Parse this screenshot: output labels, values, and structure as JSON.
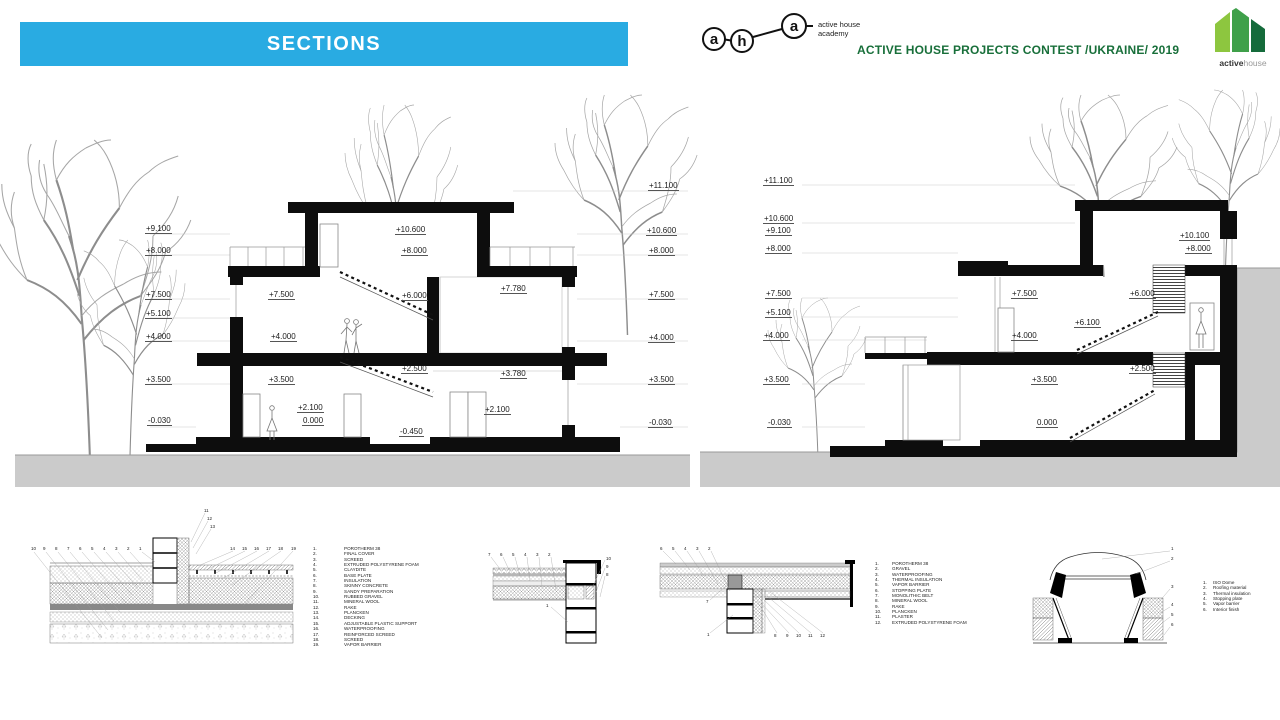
{
  "header": {
    "title": "SECTIONS",
    "academy": {
      "l1": "a",
      "l2": "h",
      "l3": "a",
      "line1": "active house",
      "line2": "academy"
    },
    "contest": "ACTIVE HOUSE  PROJECTS CONTEST /UKRAINE/  2019",
    "brand": {
      "bold": "active",
      "light": "house"
    }
  },
  "colors": {
    "banner_blue": "#29ABE2",
    "contest_green": "#186F3A",
    "logo_light_green": "#8DC63F",
    "logo_mid_green": "#3FA04A",
    "logo_dark_green": "#156B3B",
    "ground_gray": "#CBCBCB"
  },
  "sections": {
    "left": {
      "labels": [
        {
          "t": "+9.100",
          "x": 145,
          "y": 225
        },
        {
          "t": "+8.000",
          "x": 145,
          "y": 247
        },
        {
          "t": "+7.500",
          "x": 145,
          "y": 291
        },
        {
          "t": "+5.100",
          "x": 145,
          "y": 310
        },
        {
          "t": "+4.000",
          "x": 145,
          "y": 333
        },
        {
          "t": "+3.500",
          "x": 145,
          "y": 376
        },
        {
          "t": "-0.030",
          "x": 147,
          "y": 417
        },
        {
          "t": "+7.500",
          "x": 268,
          "y": 291
        },
        {
          "t": "+4.000",
          "x": 270,
          "y": 333
        },
        {
          "t": "+3.500",
          "x": 268,
          "y": 376
        },
        {
          "t": "+2.100",
          "x": 297,
          "y": 404
        },
        {
          "t": "0.000",
          "x": 302,
          "y": 417
        },
        {
          "t": "+10.600",
          "x": 395,
          "y": 226
        },
        {
          "t": "+8.000",
          "x": 401,
          "y": 247
        },
        {
          "t": "+6.000",
          "x": 401,
          "y": 292
        },
        {
          "t": "+2.500",
          "x": 401,
          "y": 365
        },
        {
          "t": "-0.450",
          "x": 399,
          "y": 428
        },
        {
          "t": "+7.780",
          "x": 500,
          "y": 285
        },
        {
          "t": "+3.780",
          "x": 500,
          "y": 370
        },
        {
          "t": "+2.100",
          "x": 484,
          "y": 406
        },
        {
          "t": "+11.100",
          "x": 648,
          "y": 182
        },
        {
          "t": "+10.600",
          "x": 646,
          "y": 227
        },
        {
          "t": "+8.000",
          "x": 648,
          "y": 247
        },
        {
          "t": "+7.500",
          "x": 648,
          "y": 291
        },
        {
          "t": "+4.000",
          "x": 648,
          "y": 334
        },
        {
          "t": "+3.500",
          "x": 648,
          "y": 376
        },
        {
          "t": "-0.030",
          "x": 648,
          "y": 419
        }
      ]
    },
    "right": {
      "labels": [
        {
          "t": "+11.100",
          "x": 763,
          "y": 177
        },
        {
          "t": "+10.600",
          "x": 763,
          "y": 215
        },
        {
          "t": "+9.100",
          "x": 765,
          "y": 227
        },
        {
          "t": "+8.000",
          "x": 765,
          "y": 245
        },
        {
          "t": "+7.500",
          "x": 765,
          "y": 290
        },
        {
          "t": "+5.100",
          "x": 765,
          "y": 309
        },
        {
          "t": "+4.000",
          "x": 763,
          "y": 332
        },
        {
          "t": "+3.500",
          "x": 763,
          "y": 376
        },
        {
          "t": "-0.030",
          "x": 767,
          "y": 419
        },
        {
          "t": "+7.500",
          "x": 1011,
          "y": 290
        },
        {
          "t": "+4.000",
          "x": 1011,
          "y": 332
        },
        {
          "t": "+6.100",
          "x": 1074,
          "y": 319
        },
        {
          "t": "+6.000",
          "x": 1129,
          "y": 290
        },
        {
          "t": "+3.500",
          "x": 1031,
          "y": 376
        },
        {
          "t": "+2.500",
          "x": 1129,
          "y": 365
        },
        {
          "t": "0.000",
          "x": 1036,
          "y": 419
        },
        {
          "t": "+10.100",
          "x": 1179,
          "y": 232
        },
        {
          "t": "+8.000",
          "x": 1185,
          "y": 245
        }
      ]
    }
  },
  "details": {
    "legendA": [
      "POROTHERM 38",
      "FINAL COVER",
      "SCREED",
      "EXTRUDED POLYSTYRENE FOAM",
      "CLAYDITE",
      "BASE PLATE",
      "INSULATION",
      "SKINNY CONCRETE",
      "SANDY PREPARATION",
      "RUBBED GRAVEL",
      "MINERAL WOOL",
      "RAKE",
      "PLANCKEN",
      "DECKING",
      "ADJUSTABLE PLASTIC SUPPORT",
      "WATERPROOFING",
      "REINFORCED SCREED",
      "SCREED",
      "VAPOR BARRIER"
    ],
    "legendB": [
      "POROTHERM 38",
      "GRAVEL",
      "WATERPROOFING",
      "THERMAL INSULATION",
      "VAPOR BARRIER",
      "STOPPING PLATE",
      "MONOLITHIC BELT",
      "MINERAL WOOL",
      "RAKE",
      "PLANCKEN",
      "PLASTER",
      "EXTRUDED POLYSTYRENE FOAM"
    ],
    "legendC": [
      "ISO Dome",
      "Roofing material",
      "Thermal insulation",
      "Stopping plate",
      "Vapor barrier",
      "Interior finish"
    ],
    "d1_callouts": [
      {
        "t": "10",
        "x": 31,
        "y": 547
      },
      {
        "t": "9",
        "x": 43,
        "y": 547
      },
      {
        "t": "8",
        "x": 55,
        "y": 547
      },
      {
        "t": "7",
        "x": 67,
        "y": 547
      },
      {
        "t": "6",
        "x": 79,
        "y": 547
      },
      {
        "t": "5",
        "x": 91,
        "y": 547
      },
      {
        "t": "4",
        "x": 103,
        "y": 547
      },
      {
        "t": "3",
        "x": 115,
        "y": 547
      },
      {
        "t": "2",
        "x": 127,
        "y": 547
      },
      {
        "t": "1",
        "x": 139,
        "y": 547
      },
      {
        "t": "11",
        "x": 204,
        "y": 509
      },
      {
        "t": "12",
        "x": 207,
        "y": 517
      },
      {
        "t": "13",
        "x": 210,
        "y": 525
      },
      {
        "t": "14",
        "x": 230,
        "y": 547
      },
      {
        "t": "15",
        "x": 242,
        "y": 547
      },
      {
        "t": "16",
        "x": 254,
        "y": 547
      },
      {
        "t": "17",
        "x": 266,
        "y": 547
      },
      {
        "t": "18",
        "x": 278,
        "y": 547
      },
      {
        "t": "19",
        "x": 291,
        "y": 547
      }
    ],
    "d2_callouts": [
      {
        "t": "7",
        "x": 488,
        "y": 553
      },
      {
        "t": "6",
        "x": 500,
        "y": 553
      },
      {
        "t": "5",
        "x": 512,
        "y": 553
      },
      {
        "t": "4",
        "x": 524,
        "y": 553
      },
      {
        "t": "3",
        "x": 536,
        "y": 553
      },
      {
        "t": "2",
        "x": 548,
        "y": 553
      },
      {
        "t": "10",
        "x": 606,
        "y": 557
      },
      {
        "t": "9",
        "x": 606,
        "y": 565
      },
      {
        "t": "8",
        "x": 606,
        "y": 573
      },
      {
        "t": "1",
        "x": 546,
        "y": 604
      }
    ],
    "d3_callouts": [
      {
        "t": "6",
        "x": 660,
        "y": 547
      },
      {
        "t": "5",
        "x": 672,
        "y": 547
      },
      {
        "t": "4",
        "x": 684,
        "y": 547
      },
      {
        "t": "3",
        "x": 696,
        "y": 547
      },
      {
        "t": "2",
        "x": 708,
        "y": 547
      },
      {
        "t": "7",
        "x": 706,
        "y": 600
      },
      {
        "t": "1",
        "x": 707,
        "y": 633
      },
      {
        "t": "8",
        "x": 774,
        "y": 634
      },
      {
        "t": "9",
        "x": 786,
        "y": 634
      },
      {
        "t": "10",
        "x": 796,
        "y": 634
      },
      {
        "t": "11",
        "x": 808,
        "y": 634
      },
      {
        "t": "12",
        "x": 820,
        "y": 634
      }
    ],
    "d4_callouts": [
      {
        "t": "1",
        "x": 1171,
        "y": 547
      },
      {
        "t": "2",
        "x": 1171,
        "y": 557
      },
      {
        "t": "3",
        "x": 1171,
        "y": 585
      },
      {
        "t": "4",
        "x": 1171,
        "y": 603
      },
      {
        "t": "5",
        "x": 1171,
        "y": 613
      },
      {
        "t": "6",
        "x": 1171,
        "y": 623
      }
    ]
  }
}
